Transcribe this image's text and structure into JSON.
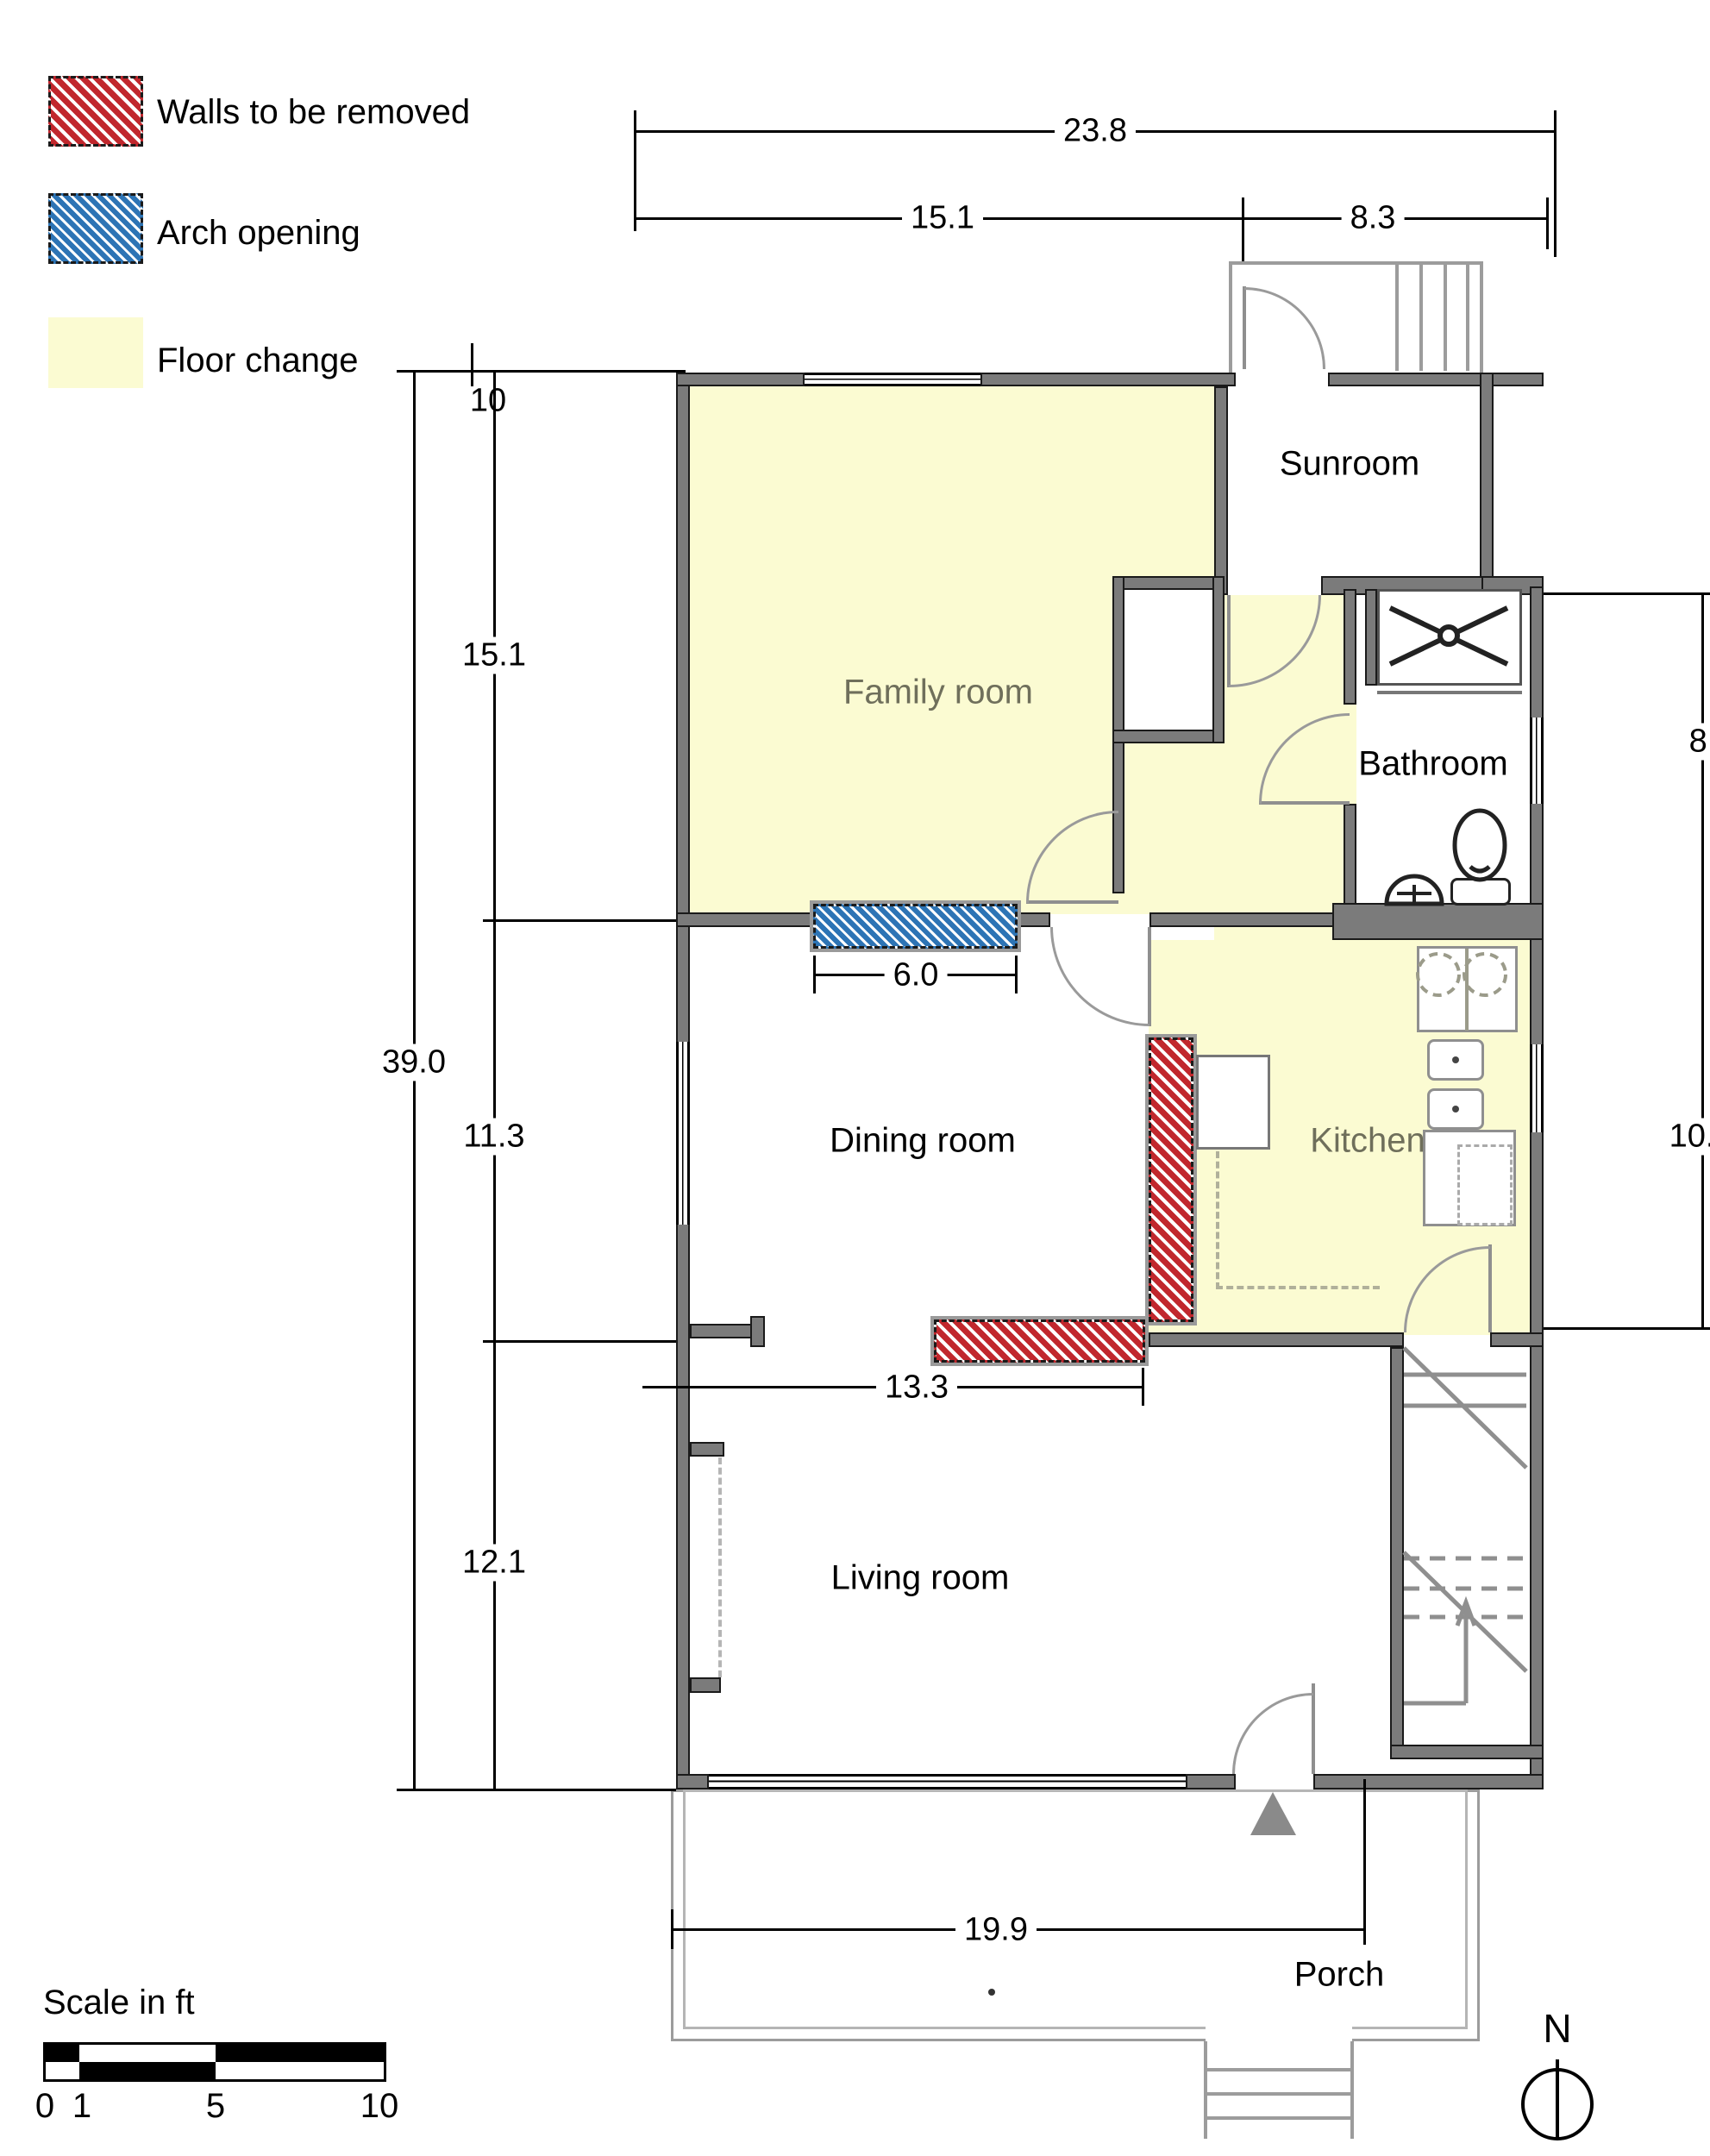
{
  "legend": {
    "items": [
      {
        "label": "Walls to be removed",
        "type": "walls-removed"
      },
      {
        "label": "Arch opening",
        "type": "arch-opening"
      },
      {
        "label": "Floor change",
        "type": "floor-change"
      }
    ]
  },
  "rooms": {
    "family": "Family room",
    "sunroom": "Sunroom",
    "bathroom": "Bathroom",
    "dining": "Dining room",
    "kitchen": "Kitchen",
    "living": "Living room",
    "porch": "Porch"
  },
  "dimensions": {
    "overall_width": "23.8",
    "upper_left": "15.1",
    "upper_right": "8.3",
    "left_note": "10",
    "v_family": "15.1",
    "v_total": "39.0",
    "v_dining": "11.3",
    "v_living": "12.1",
    "arch": "6.0",
    "removed_wall": "13.3",
    "bottom_width": "19.9",
    "right_bath": "8.0",
    "right_kitchen": "10."
  },
  "scale": {
    "title": "Scale in ft",
    "ticks": [
      "0",
      "1",
      "5",
      "10"
    ]
  },
  "compass": {
    "north": "N"
  },
  "colors": {
    "wall": "#7b7b7b",
    "remove_red": "#c1272d",
    "arch_blue": "#2d74b5",
    "floor_change": "#fbfbd2",
    "room_label_olive": "#6f6f5b"
  }
}
